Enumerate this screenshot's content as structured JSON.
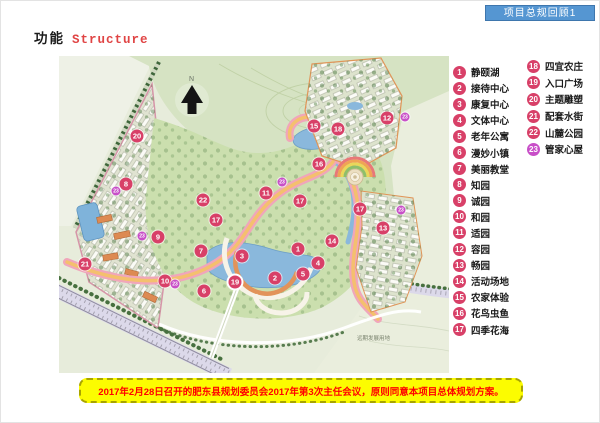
{
  "header": {
    "label": "项目总规回顾1"
  },
  "title": {
    "zh": "功能",
    "en": "Structure"
  },
  "map": {
    "north_label": "N",
    "future_land_label": "远期发展用地",
    "marker_color": "#d84068",
    "sub_marker_color": "#c84fc8",
    "markers": [
      {
        "n": "1",
        "x": 239,
        "y": 193
      },
      {
        "n": "2",
        "x": 216,
        "y": 222
      },
      {
        "n": "3",
        "x": 183,
        "y": 200
      },
      {
        "n": "4",
        "x": 259,
        "y": 207
      },
      {
        "n": "5",
        "x": 244,
        "y": 218
      },
      {
        "n": "6",
        "x": 145,
        "y": 235
      },
      {
        "n": "7",
        "x": 142,
        "y": 195
      },
      {
        "n": "8",
        "x": 67,
        "y": 128
      },
      {
        "n": "9",
        "x": 99,
        "y": 181
      },
      {
        "n": "10",
        "x": 106,
        "y": 225
      },
      {
        "n": "11",
        "x": 207,
        "y": 137
      },
      {
        "n": "12",
        "x": 328,
        "y": 62
      },
      {
        "n": "13",
        "x": 324,
        "y": 172
      },
      {
        "n": "14",
        "x": 273,
        "y": 185
      },
      {
        "n": "15",
        "x": 255,
        "y": 70
      },
      {
        "n": "16",
        "x": 260,
        "y": 108
      },
      {
        "n": "17",
        "x": 157,
        "y": 164
      },
      {
        "n": "17",
        "x": 241,
        "y": 145
      },
      {
        "n": "17",
        "x": 301,
        "y": 153
      },
      {
        "n": "18",
        "x": 279,
        "y": 73
      },
      {
        "n": "19",
        "x": 176,
        "y": 226
      },
      {
        "n": "20",
        "x": 78,
        "y": 80
      },
      {
        "n": "21",
        "x": 26,
        "y": 208
      },
      {
        "n": "22",
        "x": 144,
        "y": 144
      },
      {
        "n": "23",
        "x": 57,
        "y": 135,
        "sub": true
      },
      {
        "n": "23",
        "x": 83,
        "y": 180,
        "sub": true
      },
      {
        "n": "23",
        "x": 116,
        "y": 228,
        "sub": true
      },
      {
        "n": "23",
        "x": 223,
        "y": 126,
        "sub": true
      },
      {
        "n": "23",
        "x": 342,
        "y": 154,
        "sub": true
      },
      {
        "n": "23",
        "x": 346,
        "y": 61,
        "sub": true
      }
    ]
  },
  "legend": {
    "dot_color": "#d84068",
    "special_dot_color": "#c84fc8",
    "items": [
      {
        "n": "1",
        "label": "静颐湖"
      },
      {
        "n": "2",
        "label": "接待中心"
      },
      {
        "n": "3",
        "label": "康复中心"
      },
      {
        "n": "4",
        "label": "文体中心"
      },
      {
        "n": "5",
        "label": "老年公寓"
      },
      {
        "n": "6",
        "label": "漫妙小镇"
      },
      {
        "n": "7",
        "label": "美丽教堂"
      },
      {
        "n": "8",
        "label": "知园"
      },
      {
        "n": "9",
        "label": "诚园"
      },
      {
        "n": "10",
        "label": "和园"
      },
      {
        "n": "11",
        "label": "适园"
      },
      {
        "n": "12",
        "label": "容园"
      },
      {
        "n": "13",
        "label": "畅园"
      },
      {
        "n": "14",
        "label": "活动场地"
      },
      {
        "n": "15",
        "label": "农家体验"
      },
      {
        "n": "16",
        "label": "花鸟虫鱼"
      },
      {
        "n": "17",
        "label": "四季花海"
      },
      {
        "n": "18",
        "label": "四宜农庄"
      },
      {
        "n": "19",
        "label": "入口广场"
      },
      {
        "n": "20",
        "label": "主题雕塑"
      },
      {
        "n": "21",
        "label": "配套水街"
      },
      {
        "n": "22",
        "label": "山麓公园"
      },
      {
        "n": "23",
        "label": "管家心屋",
        "special": true
      }
    ]
  },
  "footnote": {
    "text": "2017年2月28日召开的肥东县规划委员会2017年第3次主任会议，原则同意本项目总体规划方案。"
  }
}
